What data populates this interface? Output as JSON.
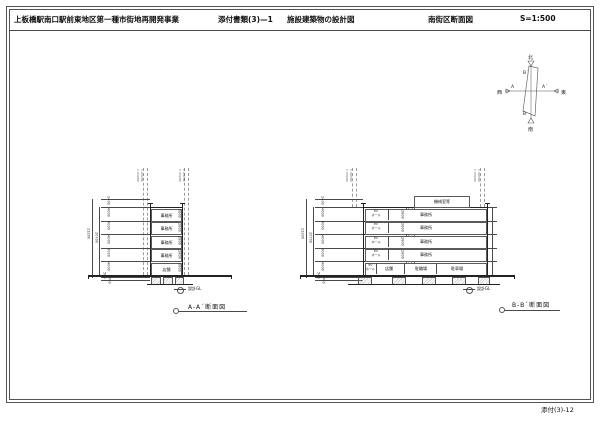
{
  "header": {
    "project": "上板橋駅南口駅前東地区第一種市街地再開発事業",
    "doc_no": "添付書類(3)—1",
    "doc_title": "施設建築物の設計図",
    "sheet_title": "南街区断面図",
    "scale": "S=1:500"
  },
  "footer": {
    "page_no": "添付(3)-12"
  },
  "keyplan": {
    "north": "北",
    "south": "南",
    "east": "東",
    "west": "西",
    "a": "A",
    "a_prime": "A´",
    "b": "B",
    "b_prime": "B´"
  },
  "dims": {
    "total": "23200",
    "sub_total": "20700",
    "parapet": "2400",
    "floor_height": "4000",
    "base": "500",
    "pit": "700",
    "ceiling": "2800",
    "level_top": "▽23200",
    "level_mid": "▽20700"
  },
  "section_a": {
    "title": "A-A´断面図",
    "gl": "設計GL",
    "floors": [
      "事務所",
      "事務所",
      "事務所",
      "事務所"
    ],
    "ground_floor": "店舗"
  },
  "section_b": {
    "title": "B-B´断面図",
    "gl": "設計GL",
    "penthouse": "機械室等",
    "hall_line1": "EV",
    "hall_line2": "ホール",
    "floors": [
      "事務所",
      "事務所",
      "事務所",
      "事務所"
    ],
    "ground_rooms": [
      "店舗",
      "駐輪場",
      "駐車場"
    ]
  }
}
